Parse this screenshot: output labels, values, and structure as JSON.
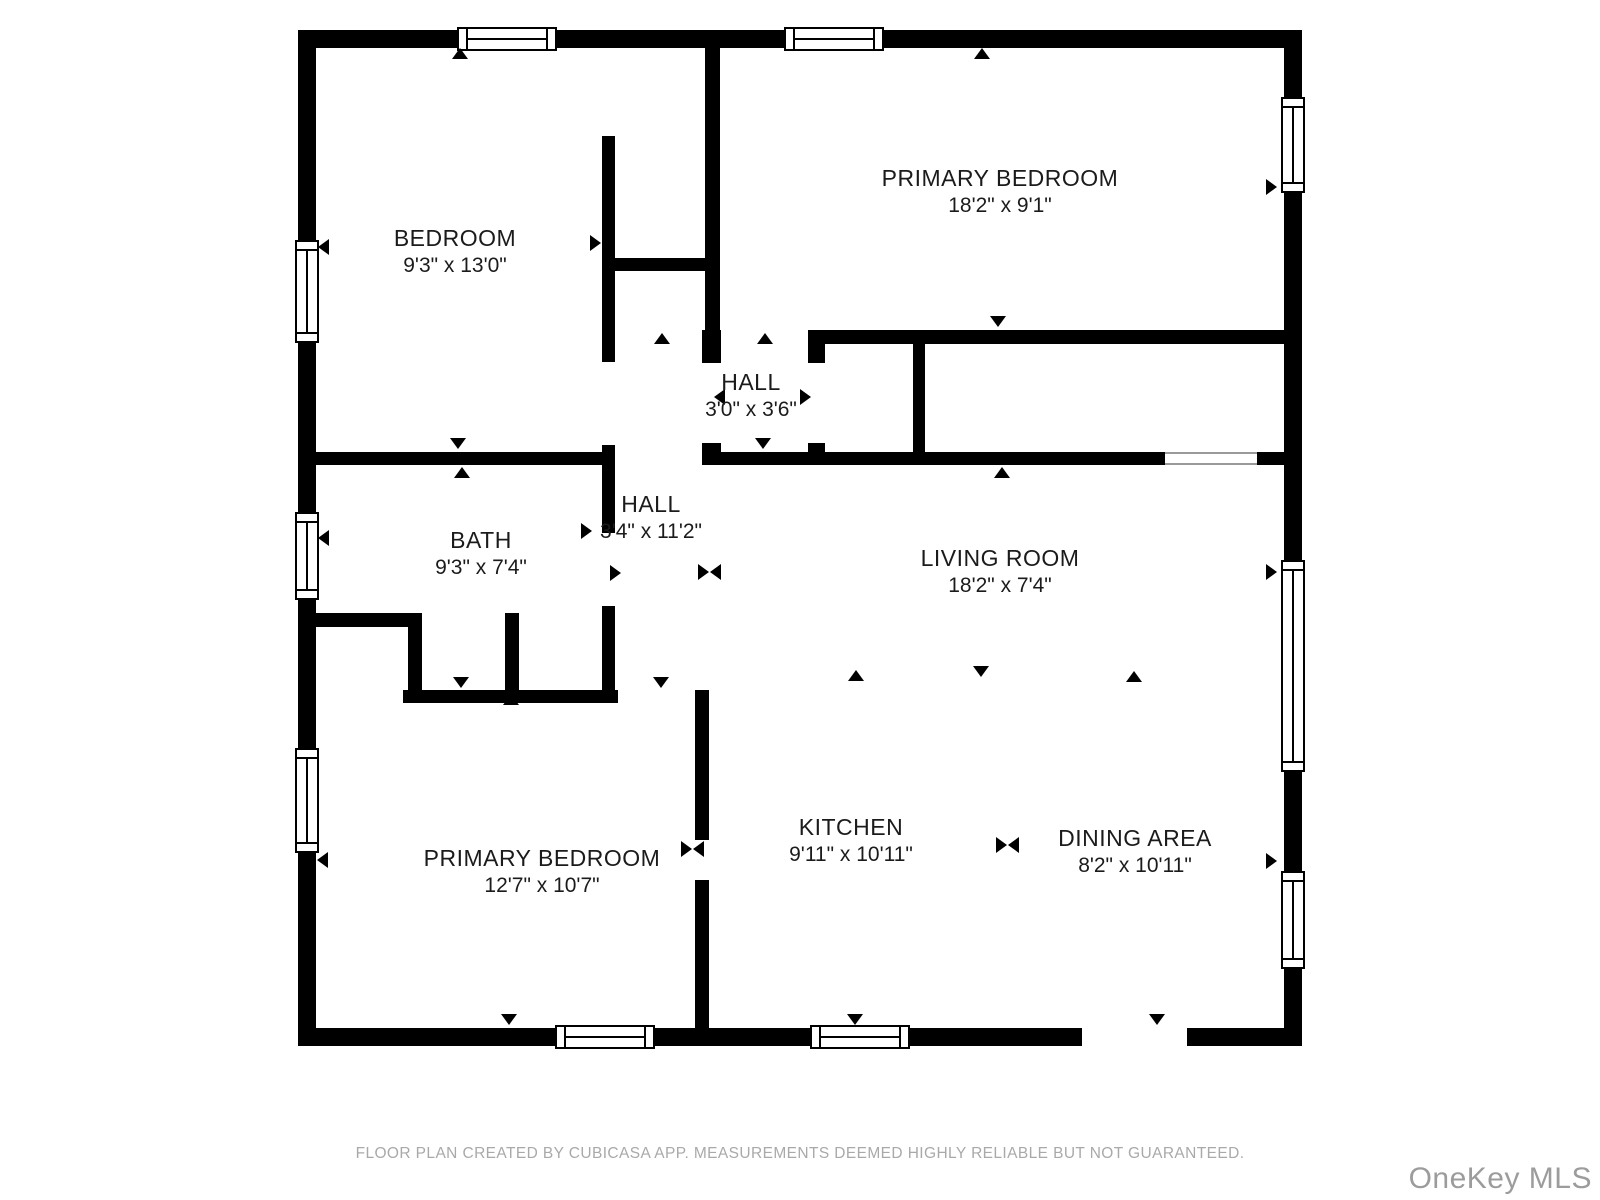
{
  "rooms": [
    {
      "name": "BEDROOM",
      "dims": "9'3\" x 13'0\""
    },
    {
      "name": "PRIMARY BEDROOM",
      "dims": "18'2\" x 9'1\""
    },
    {
      "name": "HALL",
      "dims": "3'0\" x 3'6\""
    },
    {
      "name": "BATH",
      "dims": "9'3\" x 7'4\""
    },
    {
      "name": "HALL",
      "dims": "3'4\" x 11'2\""
    },
    {
      "name": "LIVING ROOM",
      "dims": "18'2\" x 7'4\""
    },
    {
      "name": "PRIMARY BEDROOM",
      "dims": "12'7\" x 10'7\""
    },
    {
      "name": "KITCHEN",
      "dims": "9'11\" x 10'11\""
    },
    {
      "name": "DINING AREA",
      "dims": "8'2\" x 10'11\""
    }
  ],
  "footer": {
    "disclaimer": "FLOOR PLAN CREATED BY CUBICASA APP. MEASUREMENTS DEEMED HIGHLY RELIABLE BUT NOT GUARANTEED."
  },
  "watermark": {
    "text": "OneKey MLS"
  },
  "colors": {
    "wall": "#000000",
    "floor": "#ffffff",
    "label": "#1b1b1b",
    "footer_text": "#a9a9a9",
    "watermark_text": "#9c9c9c"
  }
}
